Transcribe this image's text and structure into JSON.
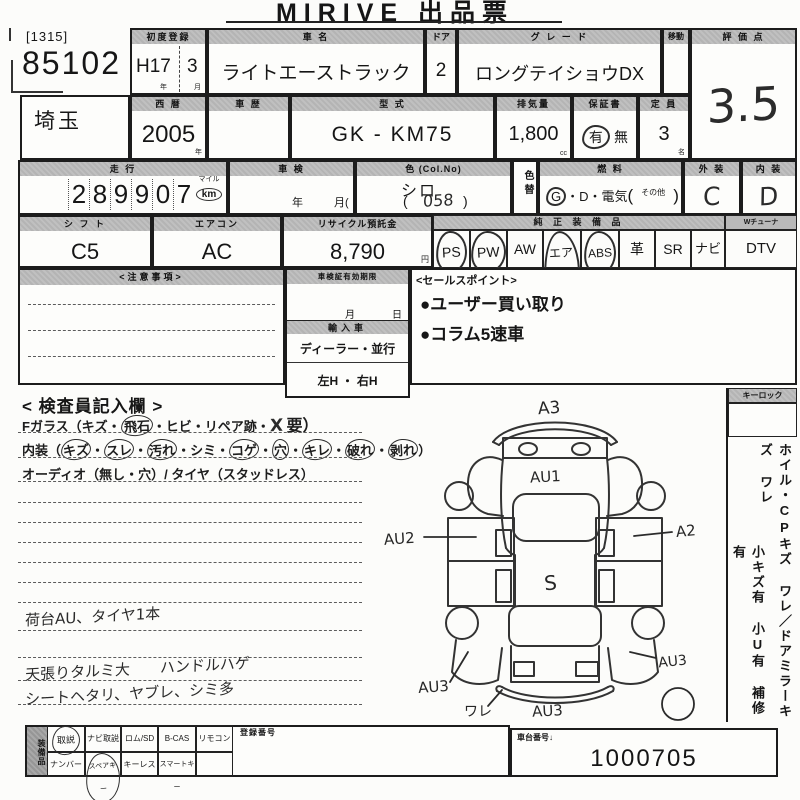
{
  "title": "MIRIVE 出品票",
  "colors": {
    "ink": "#1c1c1c",
    "header_bg": "#b9b9b9",
    "paper": "#fcfcfa"
  },
  "lot": {
    "ref": "[1315]",
    "number": "85102",
    "prefecture": "埼玉"
  },
  "row1": {
    "first_reg": {
      "label": "初度登録",
      "year": "H17",
      "month": "3",
      "year_unit": "年",
      "month_unit": "月"
    },
    "car_name": {
      "label": "車  名",
      "value": "ライトエーストラック"
    },
    "door": {
      "label": "ドア",
      "value": "2"
    },
    "grade": {
      "label": "グ レ ー ド",
      "value": "ロングテイショウDX"
    },
    "move": {
      "label": "移動"
    },
    "score": {
      "label": "評 価 点",
      "value": "3.5"
    }
  },
  "row2": {
    "year": {
      "label": "西  暦",
      "value": "2005",
      "unit": "年"
    },
    "history": {
      "label": "車  歴"
    },
    "model": {
      "label": "型  式",
      "value": "GK - KM75"
    },
    "displacement": {
      "label": "排気量",
      "value": "1,800",
      "unit": "cc"
    },
    "warranty": {
      "label": "保証書",
      "yes": "有",
      "no": "無"
    },
    "capacity": {
      "label": "定 員",
      "value": "3",
      "unit": "名"
    }
  },
  "row3": {
    "mileage": {
      "label": "走  行",
      "digits": [
        "2",
        "8",
        "9",
        "9",
        "0",
        "7"
      ],
      "mile": "マイル",
      "km": "km"
    },
    "shaken": {
      "label": "車  検",
      "year": "年",
      "month": "月("
    },
    "color": {
      "label": "色 (Col.No)",
      "value": "シロ",
      "code": "058",
      "paren_open": "(",
      "paren_close": ")"
    },
    "color_change": {
      "label": "色替"
    },
    "fuel": {
      "label": "燃  料",
      "g": "G",
      "rest": "・D・電気",
      "other": "その他",
      "paren_open": "(",
      "paren_close": ")"
    },
    "exterior": {
      "label": "外 装",
      "value": "C"
    },
    "interior": {
      "label": "内 装",
      "value": "D"
    }
  },
  "row4": {
    "shift": {
      "label": "シ フ ト",
      "value": "C5"
    },
    "aircon": {
      "label": "エアコン",
      "value": "AC"
    },
    "recycle": {
      "label": "リサイクル預託金",
      "value": "8,790",
      "unit": "円"
    },
    "equipment": {
      "label": "純 正 装 備 品",
      "dtv_label": "Wチューナ",
      "items": [
        "PS",
        "PW",
        "AW",
        "エアB",
        "ABS",
        "革",
        "SR",
        "ナビ",
        "DTV"
      ],
      "circled": [
        true,
        true,
        false,
        true,
        true,
        false,
        false,
        false,
        false
      ]
    }
  },
  "row5": {
    "caution_label": "<注意事項>",
    "validity": {
      "label": "車検証有効期限",
      "month": "月",
      "day": "日",
      "import_label": "輸入車",
      "dealer": "ディーラー・並行",
      "handle": "左H ・ 右H"
    },
    "sales": {
      "label": "<セールスポイント>",
      "points": [
        "●ユーザー買い取り",
        "●コラム5速車"
      ]
    }
  },
  "inspector": {
    "title": "< 検査員記入欄 >",
    "sep": "・",
    "fglass": {
      "p1": "Fガラス（キズ・",
      "c1": "飛石",
      "p2": "・ヒビ・リペア跡・",
      "x": "X",
      "p3": "要）"
    },
    "naiso": {
      "p1": "内装（",
      "c1": "キズ",
      "c2": "スレ",
      "c3": "汚れ",
      "p2": "・シミ・",
      "c4": "コゲ",
      "c5": "穴",
      "c6": "キレ",
      "c7": "破れ",
      "c8": "剥れ",
      "p3": "）"
    },
    "audio": "オーディオ（無し・穴）/ タイヤ（スタッドレス）",
    "notes": [
      "荷台AU、タイヤ1本",
      "天張りタルミ大　　ハンドルハゲ",
      "シートヘタリ、ヤブレ、シミ多"
    ]
  },
  "diagram": {
    "a3": "A3",
    "au1": "AU1",
    "au2": "AU2",
    "a2": "A2",
    "s": "S",
    "au3_left": "AU3",
    "au3_right": "AU3",
    "ware": "ワレ",
    "au3_bottom": "AU3"
  },
  "sidebar": {
    "keylock": "キーロック",
    "line1": "ホイル・CPキズ ワレ／ドアミラーキズ ワレ",
    "line2": "小キズ有 小U有 補修有"
  },
  "bottom": {
    "vertical_label": "装備品",
    "row1": [
      "取説",
      "ナビ取説",
      "ロム/SD",
      "B-CAS",
      "リモコン"
    ],
    "row1_circled": [
      true,
      false,
      false,
      false,
      false
    ],
    "row2": [
      "ナンバー",
      "スペアキー",
      "キーレス",
      "スマートキー"
    ],
    "row2_circled": [
      false,
      true,
      false,
      false
    ],
    "reg_no_label": "登録番号",
    "chassis": {
      "label": "車台番号↓",
      "value": "1000705"
    }
  }
}
